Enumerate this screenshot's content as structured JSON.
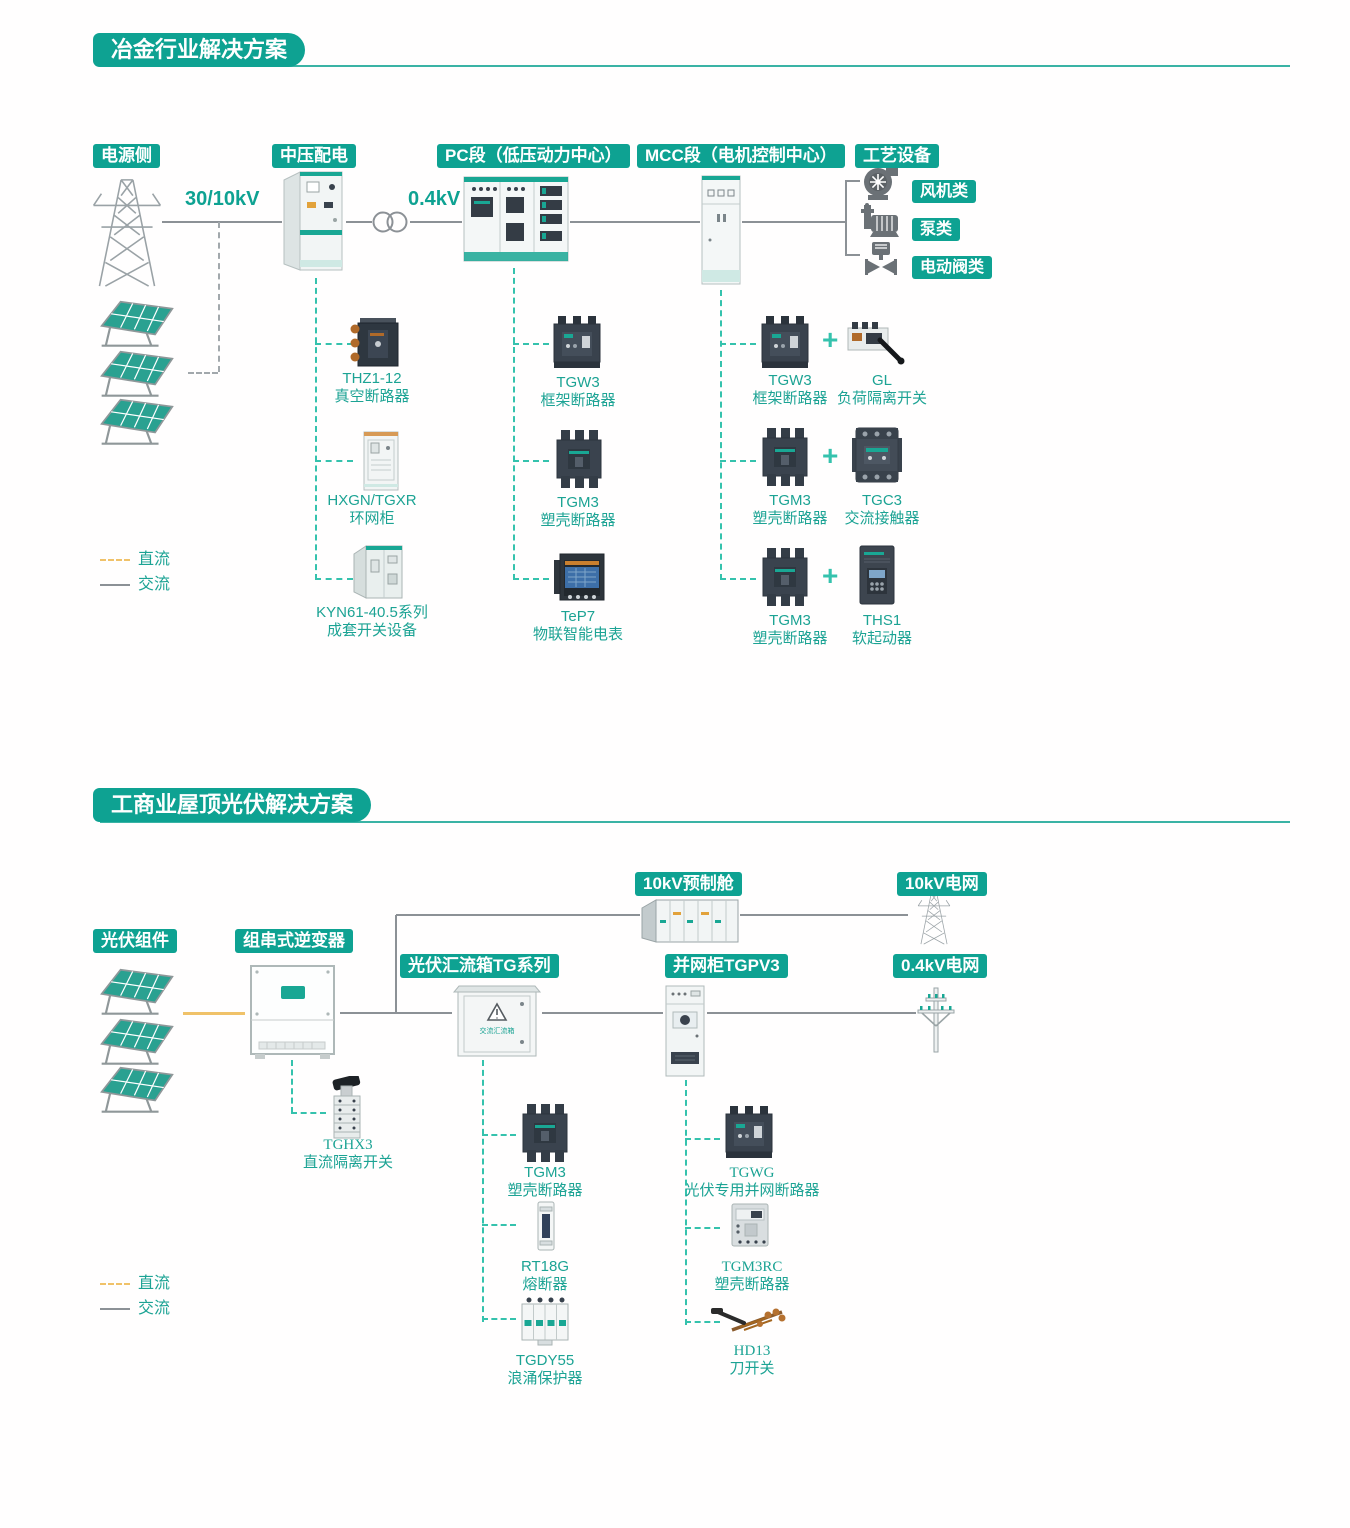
{
  "colors": {
    "accent": "#0ea292",
    "connector_dash": "#35c2ad",
    "dc_line": "#f0c269",
    "ac_line": "#8c9196",
    "label_text": "#1ca394",
    "device_dark": "#3a434e"
  },
  "s1": {
    "title": "冶金行业解决方案",
    "headers": {
      "source": "电源侧",
      "mv": "中压配电",
      "pc": "PC段（低压动力中心）",
      "mcc": "MCC段（电机控制中心）",
      "process": "工艺设备"
    },
    "voltages": {
      "hv": "30/10kV",
      "lv": "0.4kV"
    },
    "loads": [
      "风机类",
      "泵类",
      "电动阀类"
    ],
    "mv_items": [
      {
        "model": "THZ1-12",
        "name": "真空断路器"
      },
      {
        "model": "HXGN/TGXR",
        "name": "环网柜"
      },
      {
        "model": "KYN61-40.5系列",
        "name": "成套开关设备"
      }
    ],
    "pc_items": [
      {
        "model": "TGW3",
        "name": "框架断路器"
      },
      {
        "model": "TGM3",
        "name": "塑壳断路器"
      },
      {
        "model": "TeP7",
        "name": "物联智能电表"
      }
    ],
    "mcc_items": [
      {
        "a_model": "TGW3",
        "a_name": "框架断路器",
        "plus": "+",
        "b_model": "GL",
        "b_name": "负荷隔离开关"
      },
      {
        "a_model": "TGM3",
        "a_name": "塑壳断路器",
        "plus": "+",
        "b_model": "TGC3",
        "b_name": "交流接触器"
      },
      {
        "a_model": "TGM3",
        "a_name": "塑壳断路器",
        "plus": "+",
        "b_model": "THS1",
        "b_name": "软起动器"
      }
    ],
    "legend": {
      "dc": "直流",
      "ac": "交流"
    }
  },
  "s2": {
    "title": "工商业屋顶光伏解决方案",
    "headers": {
      "pv": "光伏组件",
      "inverter": "组串式逆变器",
      "combiner": "光伏汇流箱TG系列",
      "grid_cabinet": "并网柜TGPV3",
      "prefab": "10kV预制舱",
      "grid_10kv": "10kV电网",
      "grid_04kv": "0.4kV电网"
    },
    "combiner_box_text": "交流汇流箱",
    "inverter_item": {
      "model": "TGHX3",
      "name": "直流隔离开关"
    },
    "combiner_items": [
      {
        "model": "TGM3",
        "name": "塑壳断路器"
      },
      {
        "model": "RT18G",
        "name": "熔断器"
      },
      {
        "model": "TGDY55",
        "name": "浪涌保护器"
      }
    ],
    "grid_items": [
      {
        "model": "TGWG",
        "name": "光伏专用并网断路器"
      },
      {
        "model": "TGM3RC",
        "name": "塑壳断路器"
      },
      {
        "model": "HD13",
        "name": "刀开关"
      }
    ],
    "legend": {
      "dc": "直流",
      "ac": "交流"
    }
  },
  "icons": {
    "tower": "transmission-tower-icon",
    "solar": "solar-panel-icon",
    "transformer": "transformer-icon",
    "fan": "fan-icon",
    "pump": "pump-icon",
    "valve": "motor-valve-icon",
    "pole": "utility-pole-icon",
    "prefab": "prefab-substation-icon",
    "inverter": "string-inverter-icon",
    "combiner": "combiner-box-icon"
  }
}
